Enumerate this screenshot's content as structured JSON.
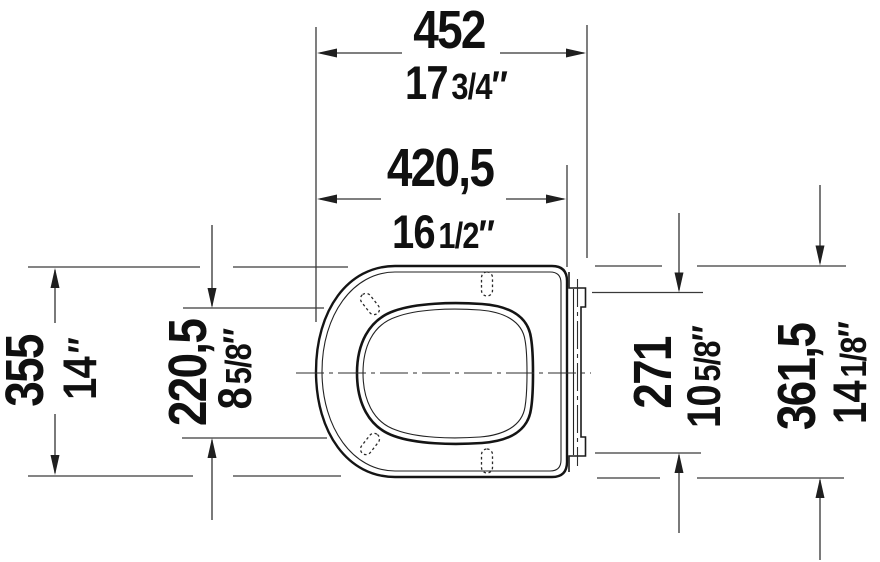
{
  "figure": {
    "description": "Technical plan-view dimension drawing of a toilet seat with hinge mounting plate",
    "background": "#ffffff",
    "line_color": "#3a3a3a",
    "outline_color": "#141414",
    "text_color": "#101010",
    "inch_mark": "″",
    "dims": {
      "overall_width": {
        "mm": "452",
        "in_whole": "17",
        "in_frac": "3/4"
      },
      "body_width": {
        "mm": "420,5",
        "in_whole": "16",
        "in_frac": "1/2"
      },
      "overall_depth": {
        "mm": "355",
        "in_whole": "14",
        "in_frac": ""
      },
      "hinge_inner": {
        "mm": "220,5",
        "in_whole": "8",
        "in_frac": "5/8"
      },
      "hinge_plate": {
        "mm": "271",
        "in_whole": "10",
        "in_frac": "5/8"
      },
      "seat_depth": {
        "mm": "361,5",
        "in_whole": "14",
        "in_frac": "1/8"
      }
    }
  }
}
